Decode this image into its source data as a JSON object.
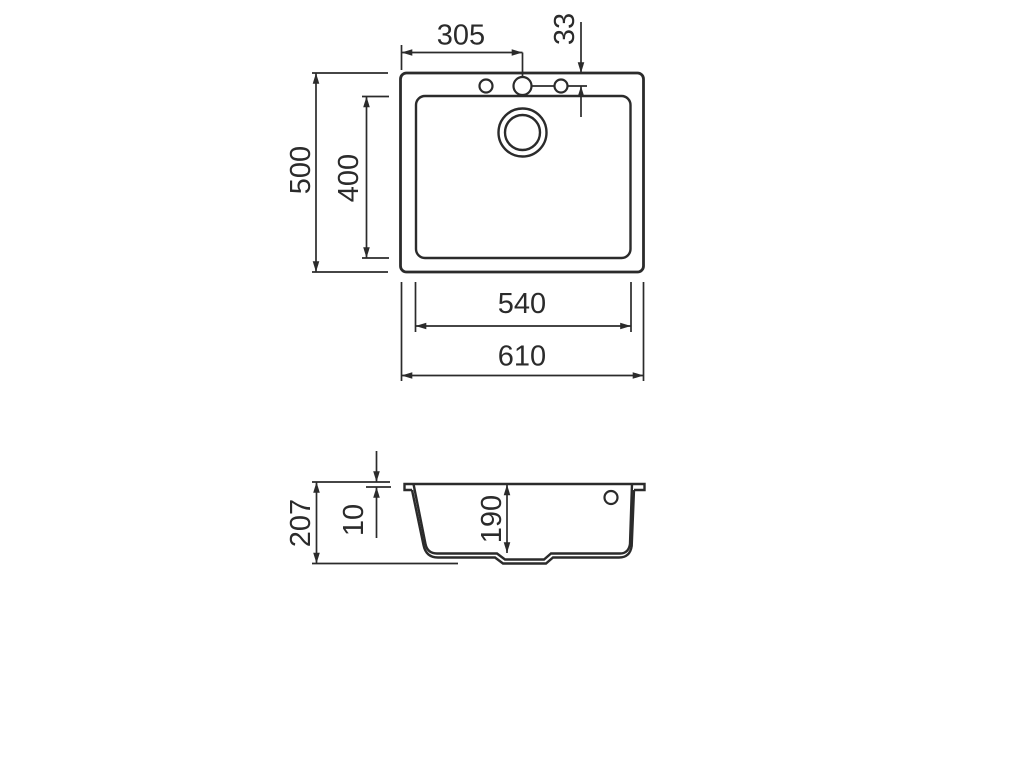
{
  "drawing": {
    "background_color": "#ffffff",
    "line_color": "#2b2b2b",
    "top_view": {
      "overall_width_mm": "610",
      "bowl_width_mm": "540",
      "overall_depth_mm": "500",
      "bowl_depth_mm": "400",
      "tap_hole_offset_from_left_mm": "305",
      "tap_hole_offset_from_edge_mm": "33"
    },
    "section_view": {
      "overall_height_mm": "207",
      "rim_thickness_mm": "10",
      "bowl_depth_mm": "190"
    }
  }
}
